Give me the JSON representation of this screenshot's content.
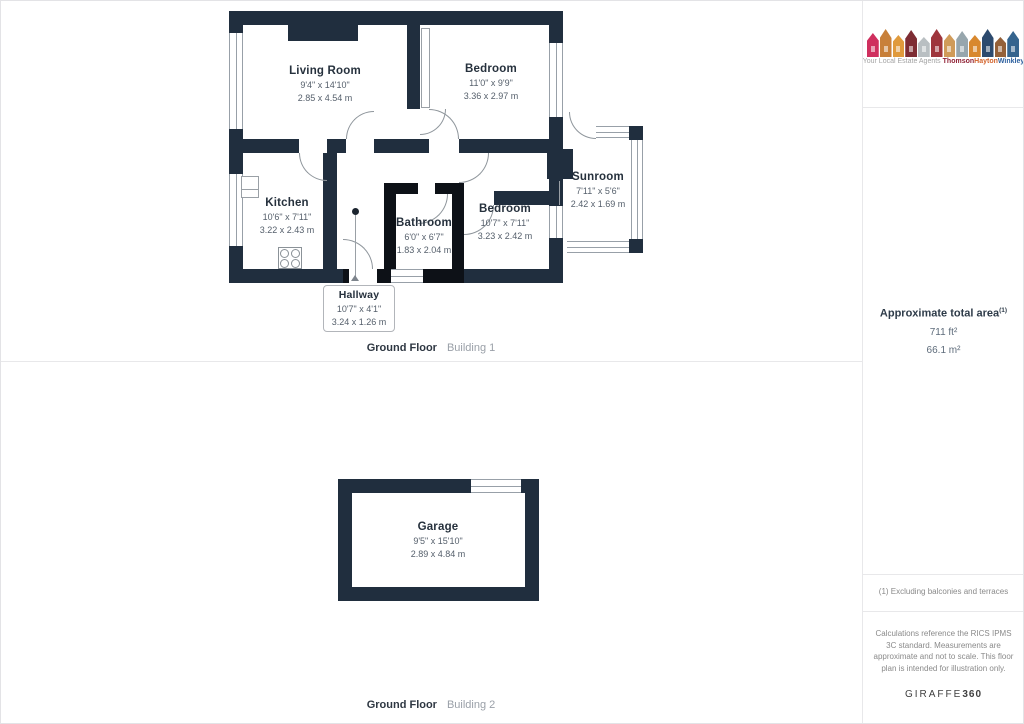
{
  "branding": {
    "tagline": "Your Local Estate Agents",
    "brand_words": [
      {
        "text": "Thomson",
        "color": "#8f2033"
      },
      {
        "text": "Hayton",
        "color": "#d2622a"
      },
      {
        "text": "Winkley",
        "color": "#2b5f9e"
      }
    ],
    "houses": [
      {
        "color": "#cf2f5e",
        "height": 24
      },
      {
        "color": "#c8803a",
        "height": 28
      },
      {
        "color": "#e09a3c",
        "height": 22
      },
      {
        "color": "#7e2d34",
        "height": 27
      },
      {
        "color": "#b9bfc2",
        "height": 20
      },
      {
        "color": "#9e353c",
        "height": 28
      },
      {
        "color": "#d09b59",
        "height": 23
      },
      {
        "color": "#97a6ad",
        "height": 26
      },
      {
        "color": "#d8882e",
        "height": 22
      },
      {
        "color": "#2c4a6e",
        "height": 28
      },
      {
        "color": "#946038",
        "height": 20
      },
      {
        "color": "#35648e",
        "height": 26
      }
    ]
  },
  "sidebar": {
    "total_area_label": "Approximate total area",
    "total_area_superscript": "(1)",
    "total_area_ft": "711 ft²",
    "total_area_m": "66.1 m²",
    "footnote": "(1) Excluding balconies and terraces",
    "disclaimer": "Calculations reference the RICS IPMS 3C standard. Measurements are approximate and not to scale. This floor plan is intended for illustration only.",
    "provider_name": "GIRAFFE",
    "provider_suffix": "360"
  },
  "floors": [
    {
      "label_bold": "Ground Floor",
      "label_light": "Building 1"
    },
    {
      "label_bold": "Ground Floor",
      "label_light": "Building 2"
    }
  ],
  "rooms": [
    {
      "name": "Living Room",
      "imperial": "9'4\" x 14'10\"",
      "metric": "2.85 x 4.54 m"
    },
    {
      "name": "Bedroom",
      "imperial": "11'0\" x 9'9\"",
      "metric": "3.36 x 2.97 m"
    },
    {
      "name": "Sunroom",
      "imperial": "7'11\" x 5'6\"",
      "metric": "2.42 x 1.69 m"
    },
    {
      "name": "Kitchen",
      "imperial": "10'6\" x 7'11\"",
      "metric": "3.22 x 2.43 m"
    },
    {
      "name": "Bathroom",
      "imperial": "6'0\" x 6'7\"",
      "metric": "1.83 x 2.04 m"
    },
    {
      "name": "Bedroom",
      "imperial": "10'7\" x 7'11\"",
      "metric": "3.23 x 2.42 m"
    },
    {
      "name": "Hallway",
      "imperial": "10'7\" x 4'1\"",
      "metric": "3.24 x 1.26 m"
    },
    {
      "name": "Garage",
      "imperial": "9'5\" x 15'10\"",
      "metric": "2.89 x 4.84 m"
    }
  ],
  "colors": {
    "wall_navy": "#202e3e",
    "wall_black": "#0d1117",
    "room_name_text": "#26313d",
    "room_dims_text": "#555f6b",
    "divider": "#e8e8ea"
  }
}
